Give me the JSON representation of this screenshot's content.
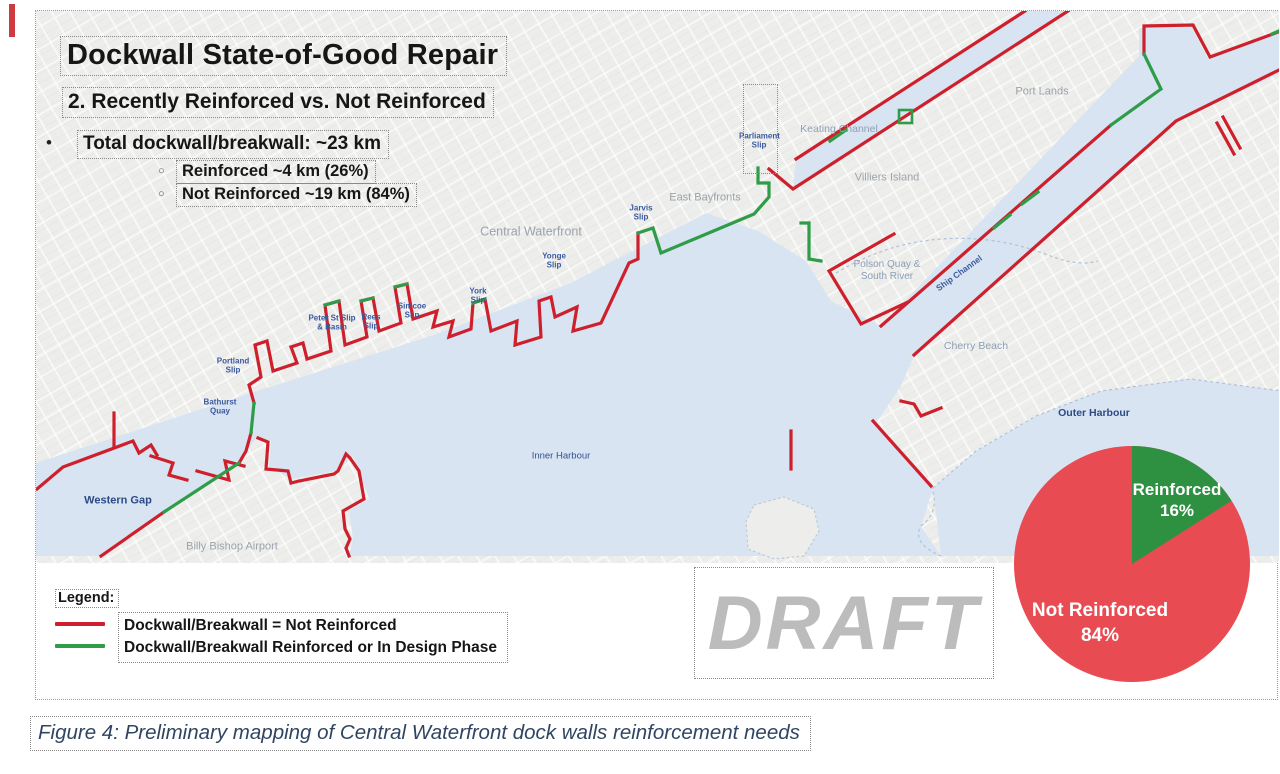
{
  "document": {
    "title": "Dockwall State-of-Good Repair",
    "subtitle": "2. Recently Reinforced vs. Not Reinforced",
    "bullet": "Total dockwall/breakwall: ~23 km",
    "sub_bullets": [
      "Reinforced ~4 km (26%)",
      "Not Reinforced ~19 km (84%)"
    ],
    "watermark": "DRAFT",
    "caption": "Figure 4: Preliminary mapping of Central Waterfront dock walls reinforcement needs"
  },
  "legend": {
    "heading": "Legend:",
    "items": [
      {
        "label": "Dockwall/Breakwall = Not Reinforced",
        "color": "#CE202C"
      },
      {
        "label": "Dockwall/Breakwall Reinforced or In Design Phase",
        "color": "#2E9C48"
      }
    ]
  },
  "map": {
    "labels": {
      "port_lands": "Port Lands",
      "keating_channel": "Keating Channel",
      "villiers_island": "Villiers Island",
      "east_bayfronts": "East Bayfronts",
      "central_waterfront": "Central Waterfront",
      "parliament_slip": "Parliament Slip",
      "jarvis_slip": "Jarvis Slip",
      "yonge_slip": "Yonge Slip",
      "york_slip": "York Slip",
      "simcoe_slip": "Simcoe Slip",
      "rees_slip": "Rees Slip",
      "peter_st_slip": "Peter St Slip & Basin",
      "portland_slip": "Portland Slip",
      "bathurst_quay": "Bathurst Quay",
      "western_gap": "Western Gap",
      "billy_bishop": "Billy Bishop Airport",
      "inner_harbour": "Inner Harbour",
      "polson_quay": "Polson Quay & South River",
      "ship_channel": "Ship Channel",
      "cherry_beach": "Cherry Beach",
      "outer_harbour": "Outer Harbour"
    }
  },
  "chart_data": {
    "type": "pie",
    "title": "",
    "slices": [
      {
        "label": "Not Reinforced",
        "value": 84,
        "color": "#E84B52"
      },
      {
        "label": "Reinforced",
        "value": 16,
        "color": "#2E9142"
      }
    ],
    "start_angle_deg": 0,
    "direction": "clockwise",
    "labels_position": "inside"
  },
  "colors": {
    "dockwall_not_reinforced": "#CE202C",
    "dockwall_reinforced": "#2E9C48",
    "pie_red": "#E84B52",
    "pie_green": "#2E9142",
    "water": "#D8E4F1",
    "land": "#EDEDEB",
    "slip_label_blue": "#3A5AA0",
    "area_label_gray": "#9CA3AB",
    "caption_text": "#2F4562",
    "watermark_gray": "#BCBCBC"
  }
}
